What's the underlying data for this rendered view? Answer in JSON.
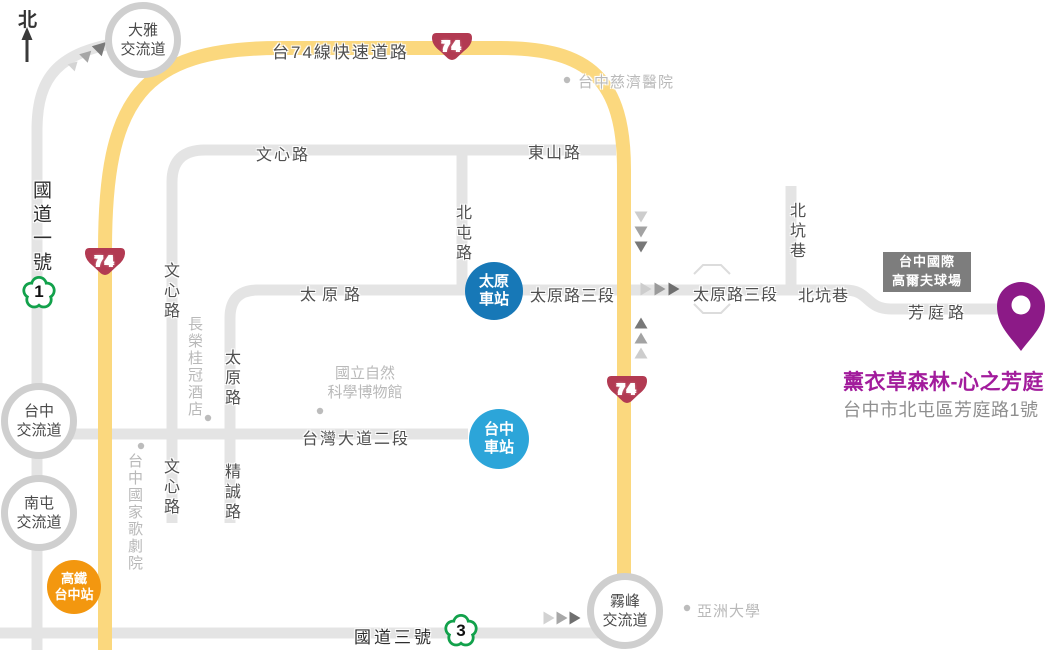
{
  "north_label": "北",
  "roads": {
    "t74_label": "台74線快速道路",
    "badge_74": "74",
    "nh1_label": "國道一號",
    "badge_1": "1",
    "nh3_label": "國道三號",
    "badge_3": "3",
    "wenxin": "文心路",
    "dongshan": "東山路",
    "beitun": "北屯路",
    "taiyuan": "太原路",
    "taiyuan_sec3": "太原路三段",
    "beikeng": "北坑巷",
    "fangting": "芳庭路",
    "taiwan_blvd": "台灣大道二段",
    "jingcheng": "精誠路"
  },
  "interchanges": {
    "daya": {
      "line1": "大雅",
      "line2": "交流道"
    },
    "taichung": {
      "line1": "台中",
      "line2": "交流道"
    },
    "nantun": {
      "line1": "南屯",
      "line2": "交流道"
    },
    "wufeng": {
      "line1": "霧峰",
      "line2": "交流道"
    }
  },
  "stations": {
    "taiyuan": {
      "line1": "太原",
      "line2": "車站"
    },
    "taichung": {
      "line1": "台中",
      "line2": "車站"
    },
    "hsr": {
      "line1": "高鐵",
      "line2": "台中站"
    }
  },
  "pois": {
    "tzuchi_hospital": "台中慈濟醫院",
    "evergreen_hotel": "長榮桂冠酒店",
    "opera_house": "台中國家歌劇院",
    "museum_line1": "國立自然",
    "museum_line2": "科學博物館",
    "asia_university": "亞洲大學",
    "golf_line1": "台中國際",
    "golf_line2": "高爾夫球場"
  },
  "destination": {
    "name": "薰衣草森林-心之芳庭",
    "address": "台中市北屯區芳庭路1號"
  },
  "colors": {
    "t74_yellow": "#fbd87e",
    "road_gray": "#e4e4e4",
    "badge74_red": "#b23a52",
    "highway_green": "#12a14b",
    "station_blue_dark": "#1778b7",
    "station_blue_light": "#2ca5d9",
    "hsr_orange": "#f3970f",
    "pin_purple": "#8c1a87",
    "destination_purple": "#a21c9c"
  }
}
